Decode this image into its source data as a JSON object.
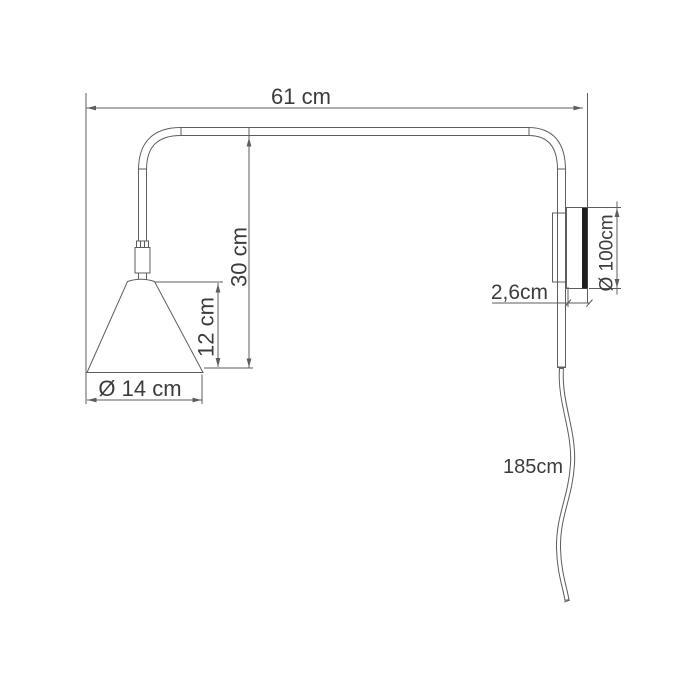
{
  "drawing": {
    "labels": {
      "arm_length": "61 cm",
      "drop_height": "30 cm",
      "shade_height": "12 cm",
      "shade_diameter": "Ø 14 cm",
      "wall_plate_depth": "2,6cm",
      "wall_plate_diameter": "Ø 100cm",
      "cord_length": "185cm"
    },
    "colors": {
      "background": "#ffffff",
      "line": "#5d5d5f",
      "text": "#3c3c3e",
      "wall_plate_fill": "#1e1e1e"
    }
  }
}
